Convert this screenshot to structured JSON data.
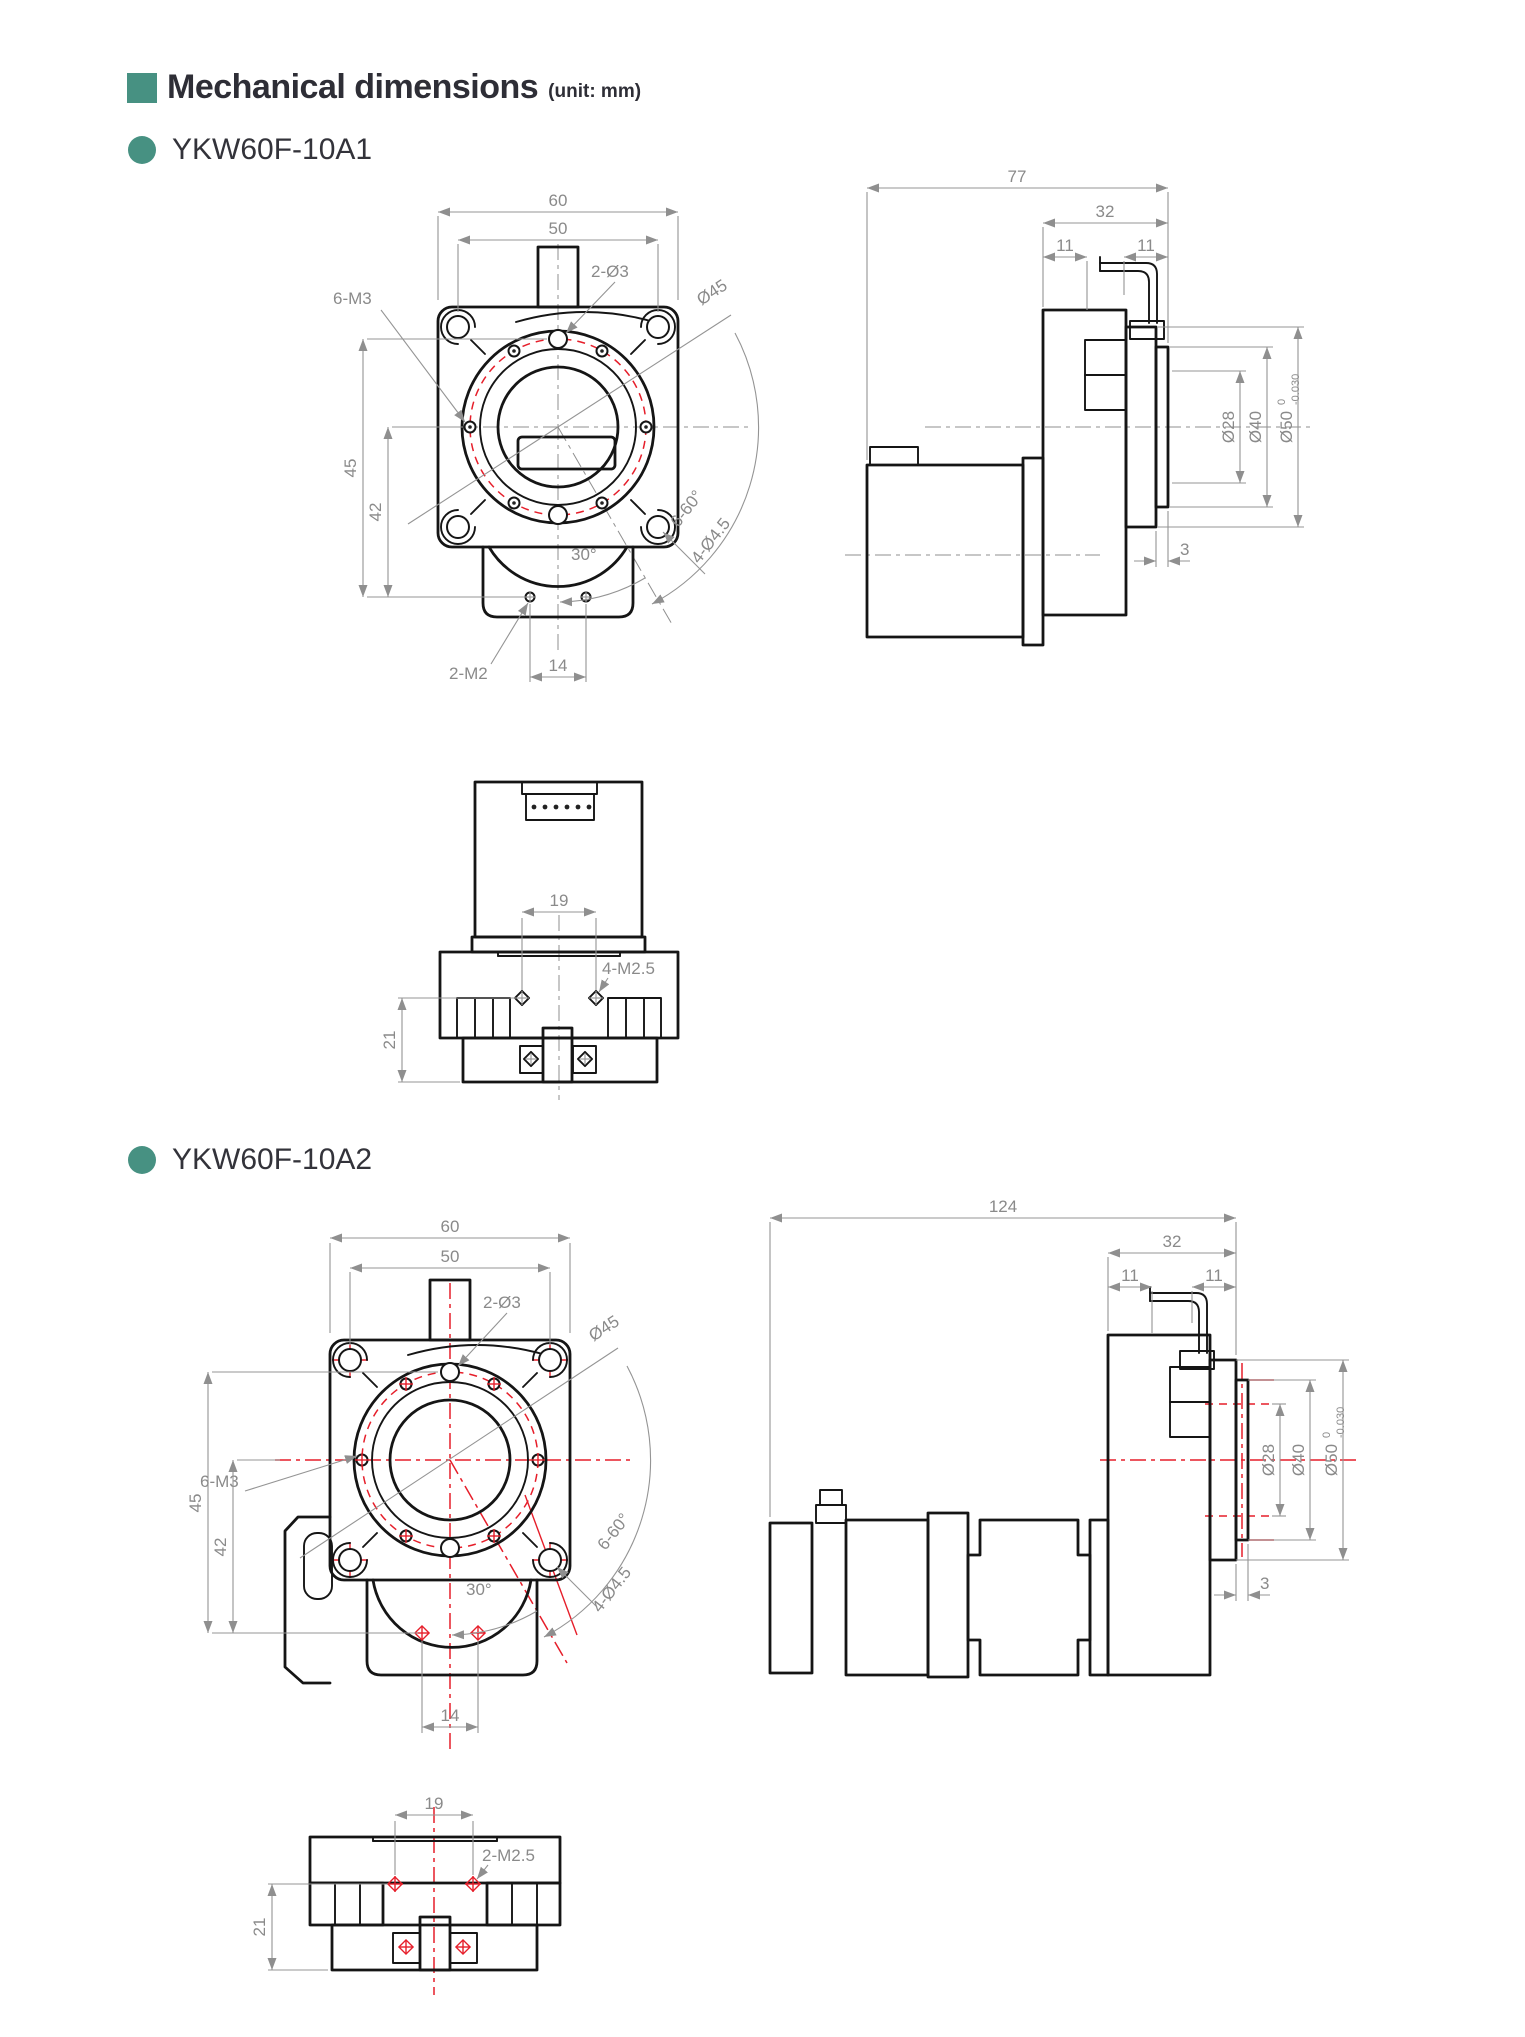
{
  "header": {
    "title": "Mechanical dimensions",
    "unit": "(unit: mm)",
    "accent_color": "#479182"
  },
  "line_colors": {
    "outline": "#151515",
    "dimension": "#8a8a8a",
    "centerline_red": "#e61e2a"
  },
  "sections": [
    {
      "title": "YKW60F-10A1",
      "front": {
        "w60": "60",
        "w50": "50",
        "top_holes": "2-Ø3",
        "bolt_circle": "Ø45",
        "m3": "6-M3",
        "h45": "45",
        "h42": "42",
        "ang30": "30°",
        "ang660": "6-60°",
        "d45h": "4-Ø4.5",
        "m2": "2-M2",
        "p14": "14"
      },
      "side": {
        "len": "77",
        "l32": "32",
        "l11a": "11",
        "l11b": "11",
        "d28": "Ø28",
        "d40": "Ø40",
        "d50": "Ø50",
        "tol_up": "0",
        "tol_dn": "-0.030",
        "p3": "3"
      },
      "bottom": {
        "p19": "19",
        "screws": "4-M2.5",
        "h21": "21"
      }
    },
    {
      "title": "YKW60F-10A2",
      "front": {
        "w60": "60",
        "w50": "50",
        "top_holes": "2-Ø3",
        "bolt_circle": "Ø45",
        "m3": "6-M3",
        "h45": "45",
        "h42": "42",
        "ang30": "30°",
        "ang660": "6-60°",
        "d45h": "4-Ø4.5",
        "p14": "14"
      },
      "side": {
        "len": "124",
        "l32": "32",
        "l11a": "11",
        "l11b": "11",
        "d28": "Ø28",
        "d40": "Ø40",
        "d50": "Ø50",
        "tol_up": "0",
        "tol_dn": "-0.030",
        "p3": "3"
      },
      "bottom": {
        "p19": "19",
        "screws": "2-M2.5",
        "h21": "21"
      }
    }
  ]
}
